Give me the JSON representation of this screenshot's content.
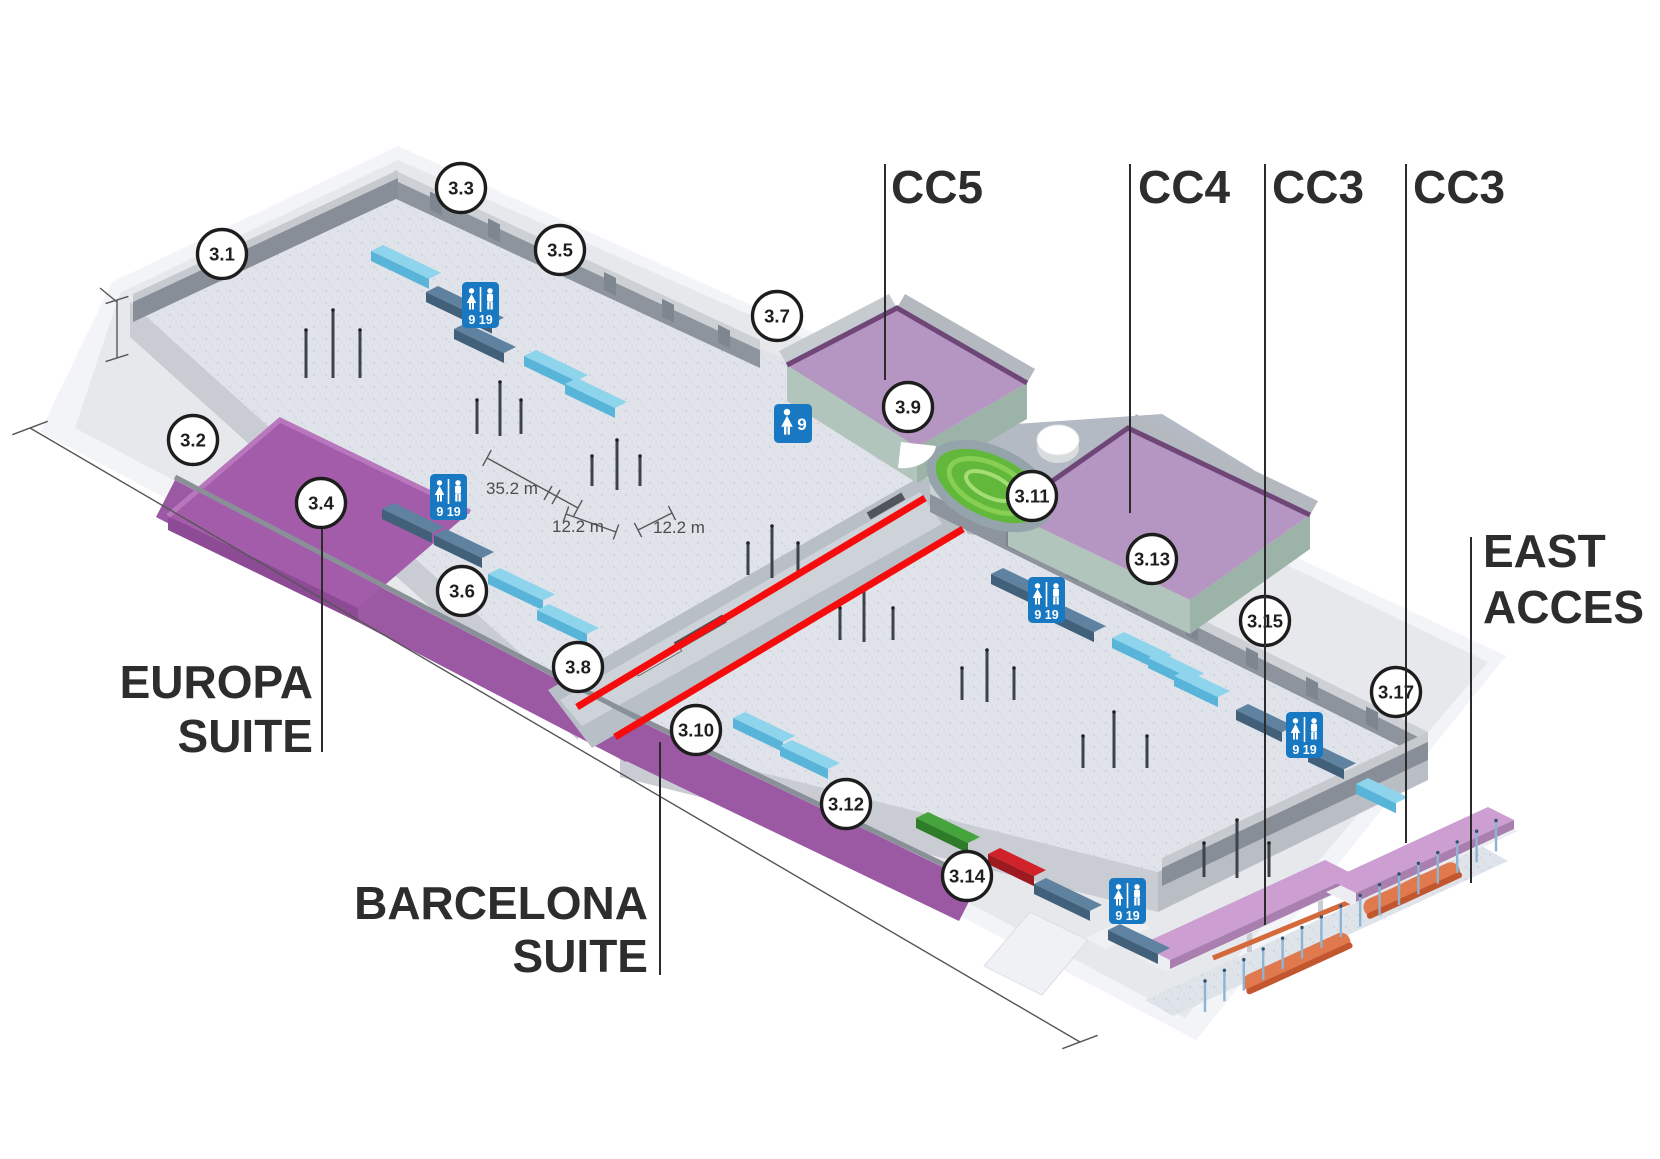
{
  "corridor_labels": {
    "cc5": "CC5",
    "cc4": "CC4",
    "cc3_a": "CC3",
    "cc3_b": "CC3"
  },
  "area_labels": {
    "east_access": {
      "line1": "EAST",
      "line2": "ACCES"
    },
    "europa_suite": {
      "line1": "EUROPA",
      "line2": "SUITE"
    },
    "barcelona_suite": {
      "line1": "BARCELONA",
      "line2": "SUITE"
    }
  },
  "markers": [
    {
      "label": "3.1"
    },
    {
      "label": "3.2"
    },
    {
      "label": "3.3"
    },
    {
      "label": "3.4"
    },
    {
      "label": "3.5"
    },
    {
      "label": "3.6"
    },
    {
      "label": "3.7"
    },
    {
      "label": "3.8"
    },
    {
      "label": "3.9"
    },
    {
      "label": "3.10"
    },
    {
      "label": "3.11"
    },
    {
      "label": "3.12"
    },
    {
      "label": "3.13"
    },
    {
      "label": "3.14"
    },
    {
      "label": "3.15"
    },
    {
      "label": "3.17"
    }
  ],
  "dimensions": [
    {
      "label": "35.2 m"
    },
    {
      "label": "12.2 m"
    },
    {
      "label": "12.2 m"
    }
  ],
  "restrooms": [
    {
      "type": "women-men",
      "numbers": "9 19"
    },
    {
      "type": "women-men",
      "numbers": "9 19"
    },
    {
      "type": "women",
      "numbers": "9"
    },
    {
      "type": "women-men",
      "numbers": "9 19"
    },
    {
      "type": "women-men",
      "numbers": "9 19"
    },
    {
      "type": "women-men",
      "numbers": "9 19"
    }
  ],
  "colors": {
    "suite_purple": "#9b58a3",
    "room_lilac": "#b595c1",
    "room_wall_green": "#b2c5bc",
    "canopy_pink": "#cc9ed1",
    "bench_light_blue": "#8ed4ec",
    "bench_steel_blue": "#5e82a0",
    "exhibit_green": "#46a43d",
    "exhibit_red": "#d1222a",
    "restroom_sign_blue": "#1878c2",
    "divider_red": "#f60c0c",
    "sculpture_orange": "#e0794e",
    "garden_green": "#62b83a"
  }
}
